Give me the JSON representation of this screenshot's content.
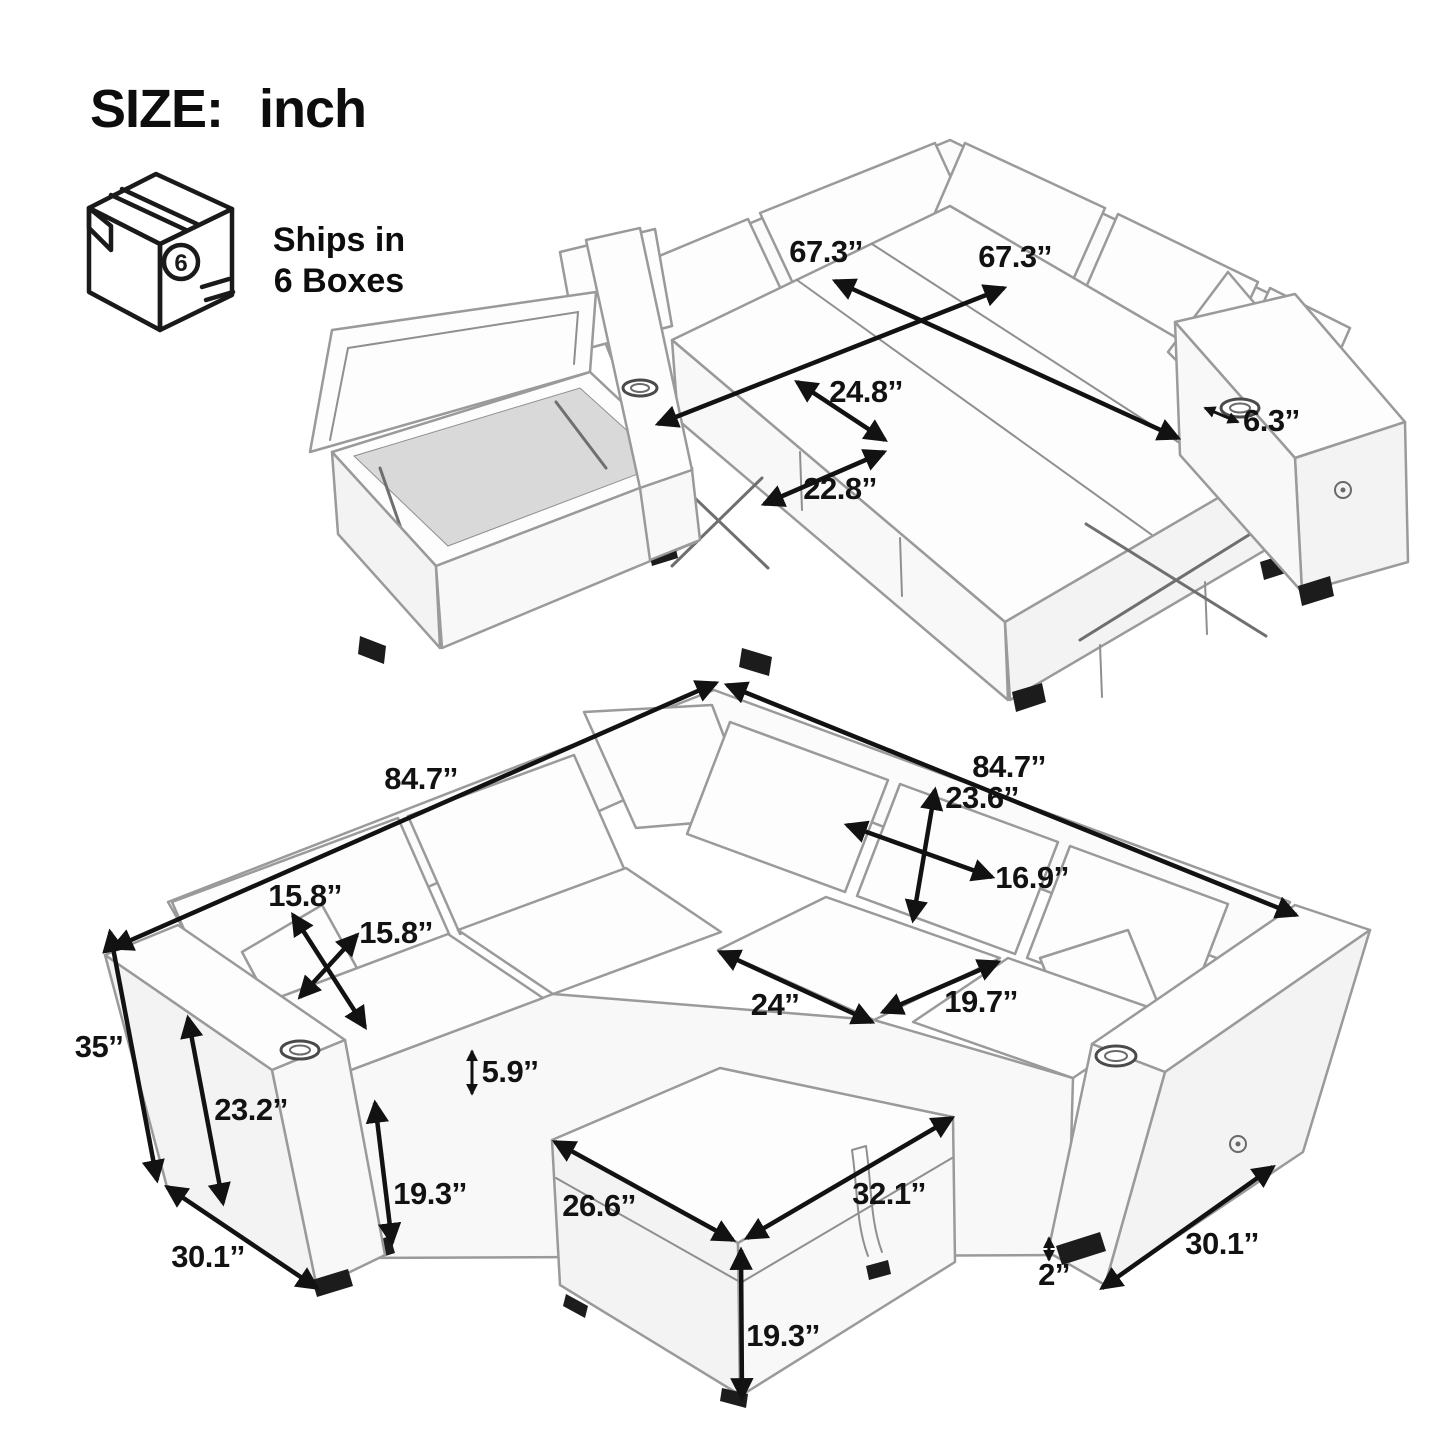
{
  "header": {
    "size_label_prefix": "SIZE:",
    "size_label_unit": "inch",
    "box_count_badge": "6",
    "shipping_line1": "Ships in",
    "shipping_line2": "6 Boxes"
  },
  "colors": {
    "background": "#ffffff",
    "text": "#0d0d0d",
    "line_art": "#9a9a9a",
    "arrow": "#121212"
  },
  "top_diagram": {
    "title": "sleeper-sofa-pulled-out-with-open-storage",
    "dimensions": [
      {
        "id": "bed-length-a",
        "text": "67.3’’"
      },
      {
        "id": "bed-length-b",
        "text": "67.3’’"
      },
      {
        "id": "pull-out-seat-depth",
        "text": "24.8’’"
      },
      {
        "id": "pull-out-seat-width",
        "text": "22.8’’"
      },
      {
        "id": "armrest-top-width",
        "text": "6.3’’"
      }
    ]
  },
  "bottom_diagram": {
    "title": "sectional-sofa-with-storage-ottoman",
    "dimensions": [
      {
        "id": "overall-width-left",
        "text": "84.7’’"
      },
      {
        "id": "overall-width-right",
        "text": "84.7’’"
      },
      {
        "id": "back-cushion-height",
        "text": "23.6’’"
      },
      {
        "id": "back-cushion-width",
        "text": "16.9’’"
      },
      {
        "id": "pillow-width",
        "text": "15.8’’"
      },
      {
        "id": "pillow-height",
        "text": "15.8’’"
      },
      {
        "id": "seat-cushion-width",
        "text": "24’’"
      },
      {
        "id": "seat-cushion-depth",
        "text": "19.7’’"
      },
      {
        "id": "overall-height",
        "text": "35’’"
      },
      {
        "id": "armrest-height",
        "text": "23.2’’"
      },
      {
        "id": "seat-cushion-thickness",
        "text": "5.9’’"
      },
      {
        "id": "seat-height",
        "text": "19.3’’"
      },
      {
        "id": "armrest-depth-left",
        "text": "30.1’’"
      },
      {
        "id": "ottoman-depth",
        "text": "26.6’’"
      },
      {
        "id": "ottoman-width",
        "text": "32.1’’"
      },
      {
        "id": "ottoman-height",
        "text": "19.3’’"
      },
      {
        "id": "armrest-depth-right",
        "text": "30.1’’"
      },
      {
        "id": "leg-height",
        "text": "2’’"
      }
    ]
  }
}
